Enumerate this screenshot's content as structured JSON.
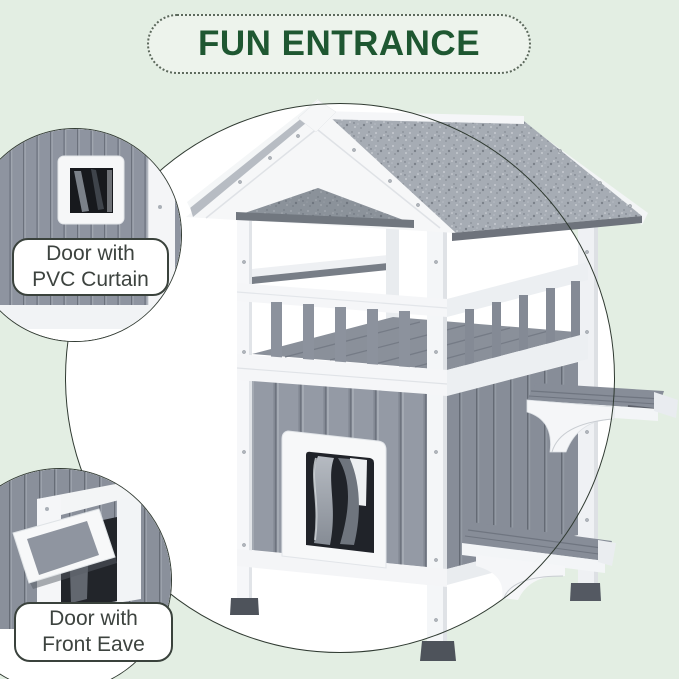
{
  "title": {
    "text": "FUN ENTRANCE"
  },
  "callouts": [
    {
      "id": "pvc-curtain-door",
      "label": {
        "line1": "Door with",
        "line2": "PVC Curtain"
      }
    },
    {
      "id": "front-eave-door",
      "label": {
        "line1": "Door with",
        "line2": "Front Eave"
      }
    }
  ],
  "product": {
    "subject": "two-story gray and white wooden cat house with gable roof, balcony, PVC curtain door and side step platforms"
  },
  "colors": {
    "background": "#e3eee3",
    "banner_fill": "#edf3ec",
    "banner_text": "#1e5731",
    "circle_outline": "#2f3a31",
    "label_text": "#3d433f",
    "house_white": "#f5f6f8",
    "house_gray": "#8d939e",
    "roof_gray": "#a6acb4",
    "foot_dark": "#4e535b"
  }
}
